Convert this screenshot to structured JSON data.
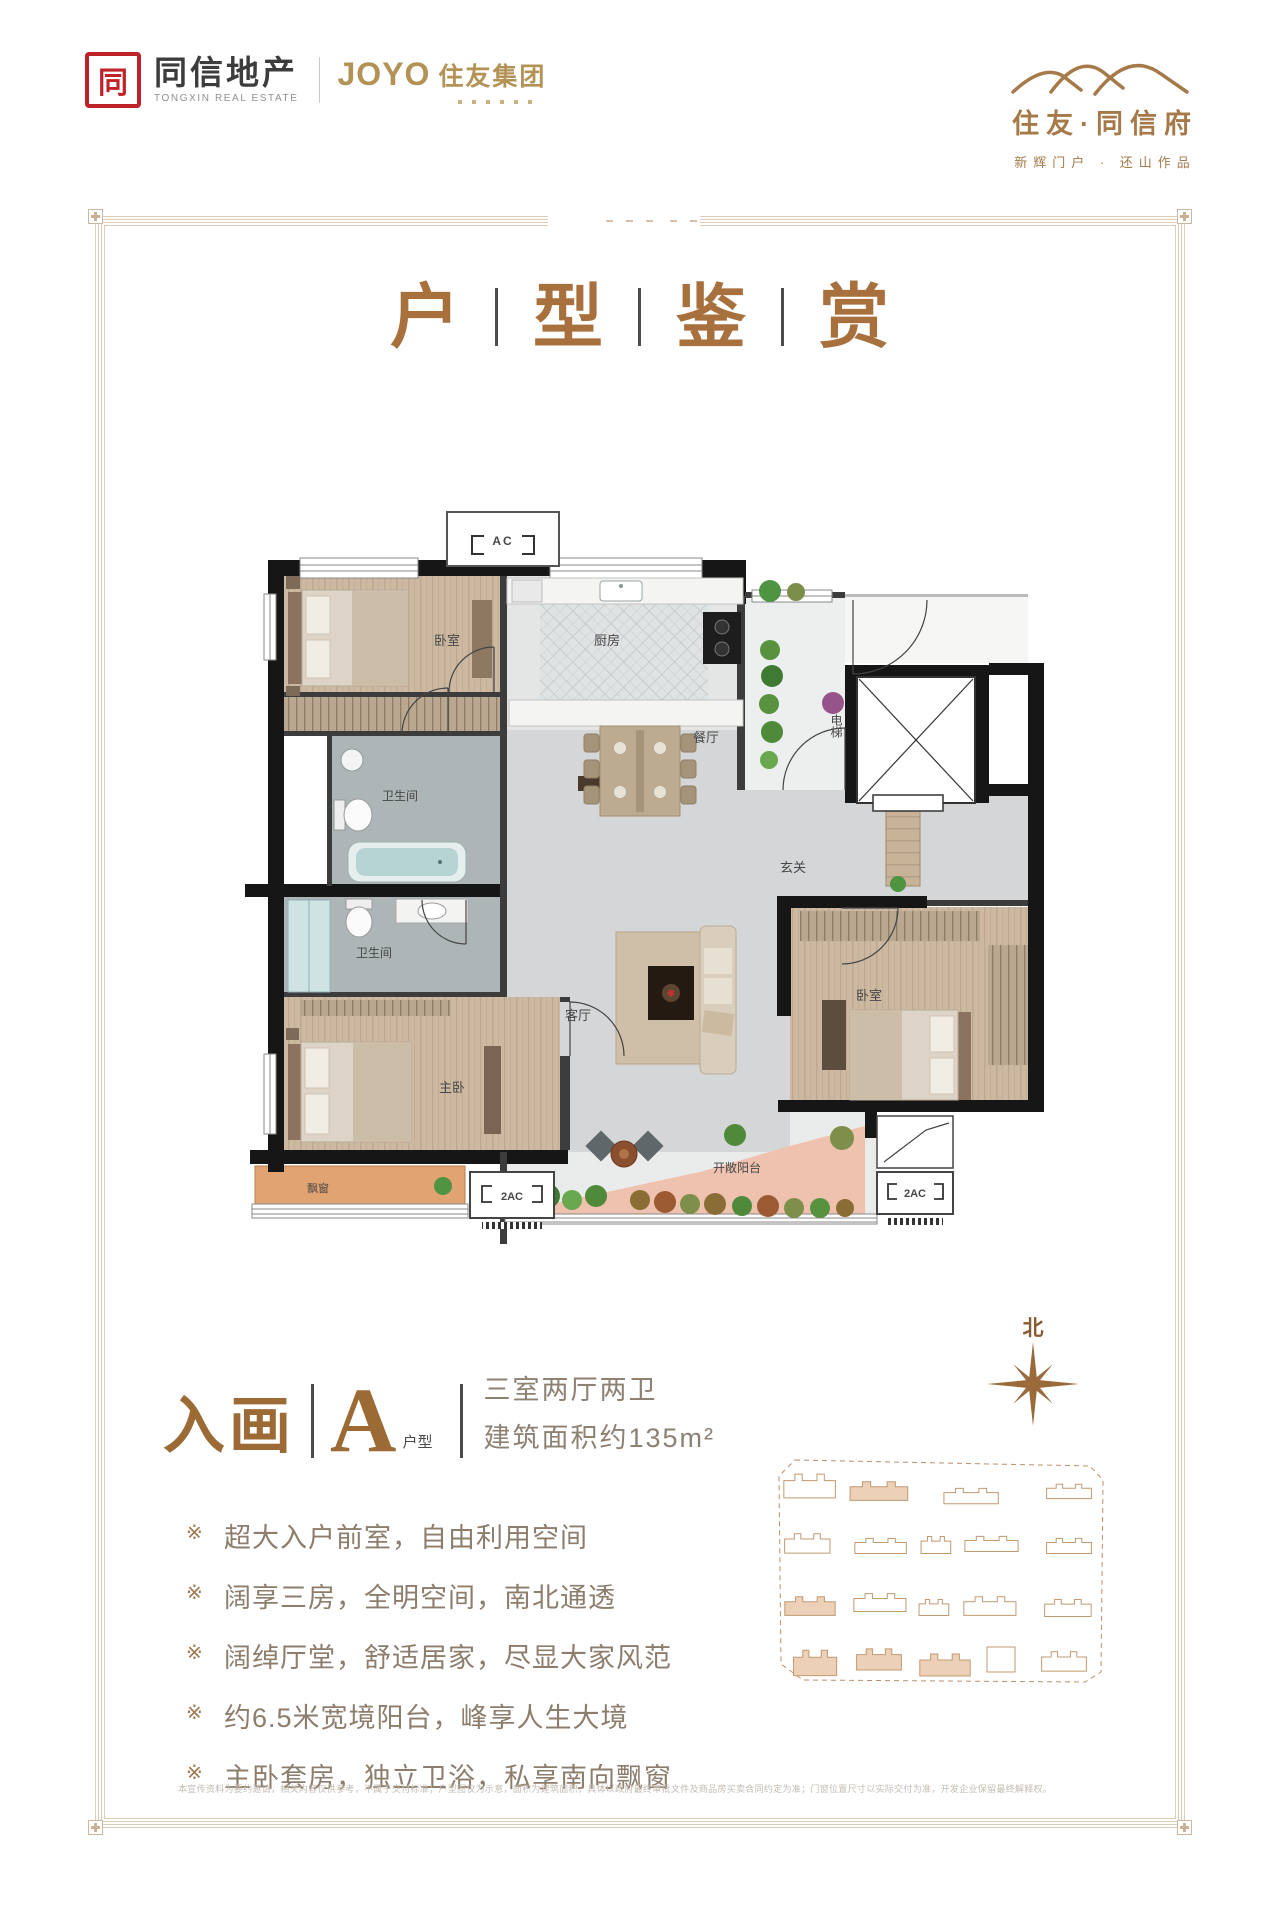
{
  "header": {
    "brand_left": {
      "mark": "同",
      "name": "同信地产",
      "name_en": "TONGXIN REAL ESTATE",
      "joyo": "JOYO",
      "joyo_cn": "住友集团"
    },
    "brand_right": {
      "name": "住友·同信府",
      "tagline": "新辉门户 · 还山作品"
    }
  },
  "title": {
    "chars": [
      "户",
      "型",
      "鉴",
      "赏"
    ]
  },
  "plan": {
    "ac_top": "AC",
    "bedroom_top": "卧室",
    "kitchen": "厨房",
    "dining": "餐厅",
    "elevator": "电梯",
    "bath_1": "卫生间",
    "bath_2": "卫生间",
    "foyer": "玄关",
    "living": "客厅",
    "master": "主卧",
    "bedroom_right": "卧室",
    "bay_window": "飘窗",
    "balcony": "开敞阳台",
    "ac_1": "2AC",
    "ac_2": "2AC"
  },
  "unit": {
    "name": "入画",
    "letter": "A",
    "letter_label": "户型",
    "rooms": "三室两厅两卫",
    "area": "建筑面积约135m²"
  },
  "features": {
    "bullet": "※",
    "items": [
      "超大入户前室，自由利用空间",
      "阔享三房，全明空间，南北通透",
      "阔绰厅堂，舒适居家，尽显大家风范",
      "约6.5米宽境阳台，峰享人生大境",
      "主卧套房，独立卫浴，私享南向飘窗"
    ]
  },
  "compass": {
    "north": "北"
  },
  "disclaimer": "本宣传资料为要约邀请，相关内容仅供参考，不属于交付标准；户型图仅为示意，面积为建筑面积，具体以政府最终审批文件及商品房买卖合同约定为准；门窗位置尺寸以实际交付为准，开发企业保留最终解释权。",
  "colors": {
    "brand_red": "#bf2329",
    "brand_gold": "#b29255",
    "title_brown": "#a7703c",
    "feature_text": "#8c7d6c"
  }
}
